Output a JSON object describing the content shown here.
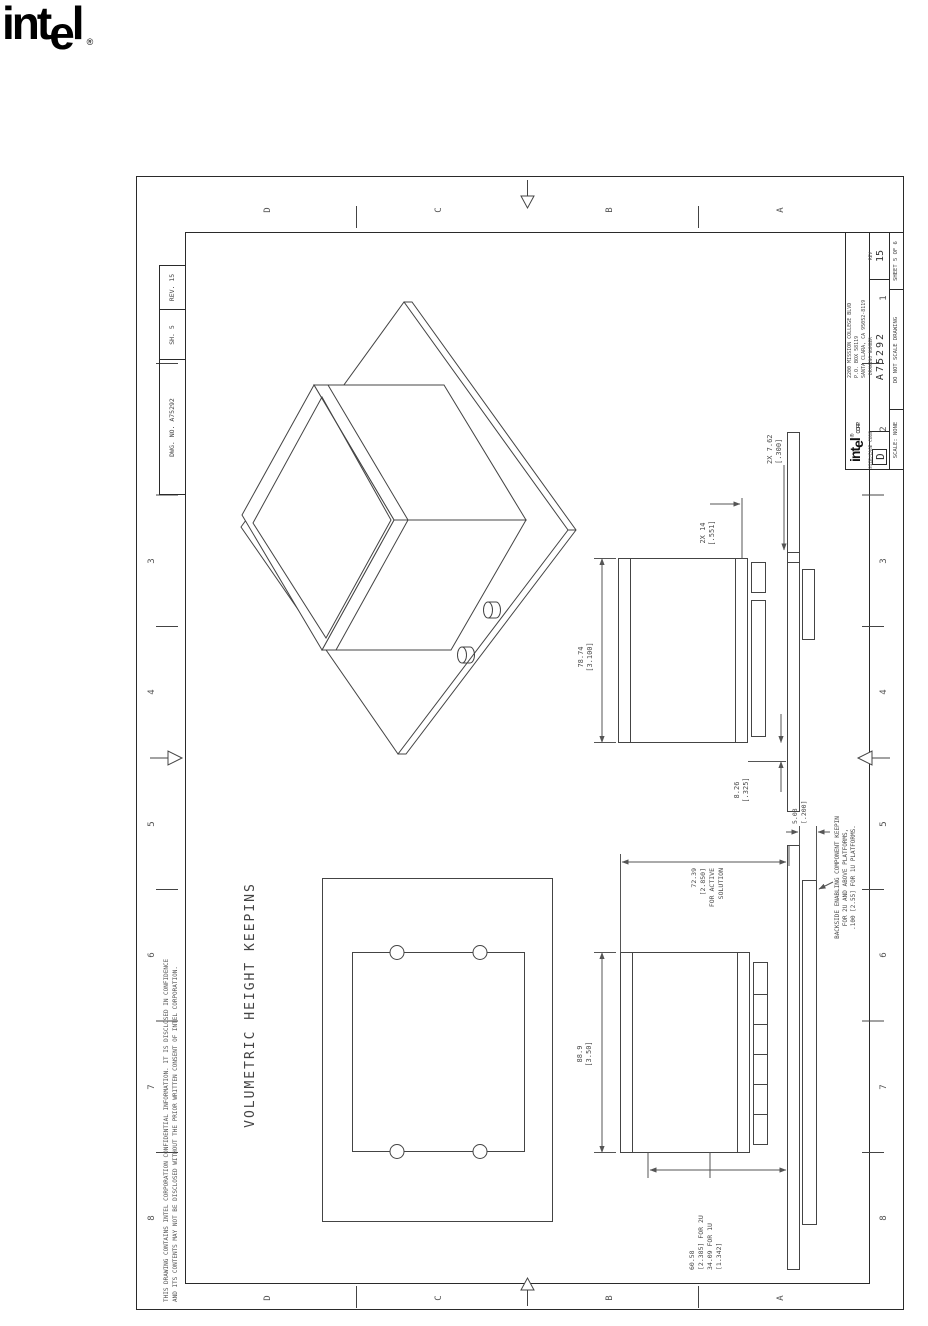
{
  "page": {
    "logo": {
      "int": "int",
      "e": "e",
      "l": "l",
      "reg": "®"
    }
  },
  "colors": {
    "ink": "#3c3c3c",
    "line": "#444444",
    "frame": "#1a1a1a"
  },
  "sheet": {
    "title": "VOLUMETRIC HEIGHT KEEPINS",
    "confidentiality": [
      "THIS DRAWING CONTAINS INTEL CORPORATION CONFIDENTIAL INFORMATION. IT IS DISCLOSED IN CONFIDENCE",
      "AND ITS CONTENTS MAY NOT BE DISCLOSED WITHOUT THE PRIOR WRITTEN CONSENT OF INTEL CORPORATION."
    ],
    "border": {
      "cols": [
        "1",
        "2",
        "3",
        "4",
        "5",
        "6",
        "7",
        "8"
      ],
      "rows": [
        "D",
        "C",
        "B",
        "A"
      ]
    },
    "ref_block": {
      "dwg": "DWG. NO. A75292",
      "sh": "SH. 5",
      "rev": "REV. 15"
    },
    "title_block": {
      "company": {
        "name_int": "int",
        "name_e": "e",
        "name_l": "l",
        "reg": "®",
        "corp": "CORP.",
        "address": [
          "2200 MISSION COLLEGE BLVD",
          "P.O. BOX 58119",
          "SANTA CLARA, CA 95052-8119"
        ]
      },
      "size_label": "SIZE/CAGE CODE",
      "size_value": "D",
      "dn_label": "DRAWING NUMBER",
      "dn_value": "A75292",
      "rev_label": "REV",
      "rev_value": "15",
      "scale": "SCALE: NONE",
      "no_scale": "DO NOT SCALE DRAWING",
      "sheet_of": "SHEET 5 OF 6"
    },
    "dims": {
      "width_right": [
        "78.74",
        "[3.100]"
      ],
      "lip": [
        "8.26",
        "[.325]"
      ],
      "holes": [
        "2X 7.62",
        "[.300]"
      ],
      "standoff": [
        "2X 14",
        "[.551]"
      ],
      "width_left": [
        "88.9",
        "[3.50]"
      ],
      "active": [
        "72.39",
        "[2.850]",
        "FOR ACTIVE",
        "SOLUTION"
      ],
      "backside_depth": [
        "5.08",
        "[.200]"
      ],
      "backside_note": [
        "BACKSIDE ENABLING COMPONENT KEEPIN",
        "FOR 2U AND ABOVE PLATFORMS,",
        ".100 [2.55] FOR 1U PLATFORMS."
      ],
      "height_2u": [
        "60.58",
        "[2.385] FOR 2U",
        "34.09 FOR 1U",
        "[1.342]"
      ]
    }
  }
}
